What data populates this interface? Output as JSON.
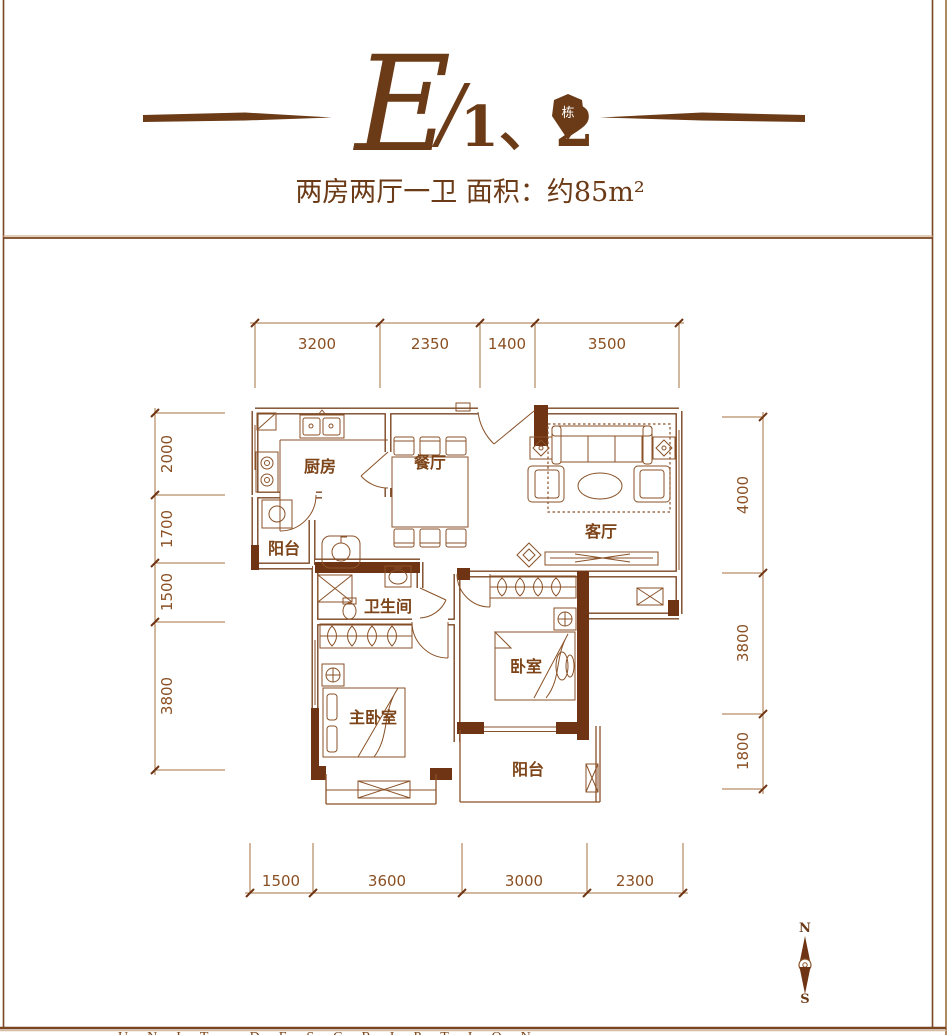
{
  "colors": {
    "line_brown": "#8A5228",
    "wall_fill": "#6E3413",
    "text_brown": "#7C4418",
    "header_brown": "#6B3A16",
    "tan_shadow": "#D8BEA2"
  },
  "header": {
    "title_letter": "E",
    "title_slash": "/",
    "title_numbers": "1、2",
    "badge_label": "栋",
    "subtitle": "两房两厅一卫  面积：约85m²"
  },
  "floor_plan": {
    "room_labels": {
      "kitchen": "厨房",
      "dining": "餐厅",
      "living": "客厅",
      "balcony_left": "阳台",
      "bathroom": "卫生间",
      "master_bedroom": "主卧室",
      "bedroom": "卧室",
      "balcony_bottom": "阳台"
    },
    "dimensions_mm": {
      "top": [
        "3200",
        "2350",
        "1400",
        "3500"
      ],
      "left": [
        "2000",
        "1700",
        "1500",
        "3800"
      ],
      "right": [
        "4000",
        "3800",
        "1800"
      ],
      "bottom": [
        "1500",
        "3600",
        "3000",
        "2300"
      ]
    }
  },
  "compass": {
    "north_label": "N",
    "south_label": "S"
  },
  "footer": {
    "caption": "UNIT DESCRIPTION"
  }
}
